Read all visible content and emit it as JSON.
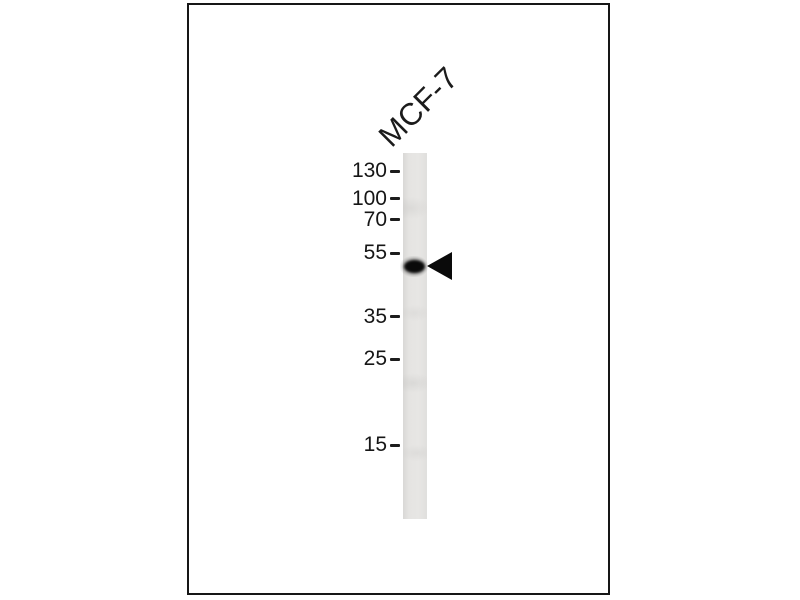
{
  "figure": {
    "type": "western-blot",
    "lane_label": "MCF-7",
    "mw_markers": [
      "130",
      "100",
      "70",
      "55",
      "35",
      "25",
      "15"
    ],
    "band": {
      "lane": "MCF-7",
      "position": "just below the 55 marker",
      "indicator": "left-pointing-arrowhead"
    },
    "colors": {
      "background": "#ffffff",
      "panel_border": "#161616",
      "lane_strip": "#e5e4e2",
      "band": "#0a0a0a",
      "arrowhead": "#0a0a0a",
      "text": "#161616"
    }
  }
}
